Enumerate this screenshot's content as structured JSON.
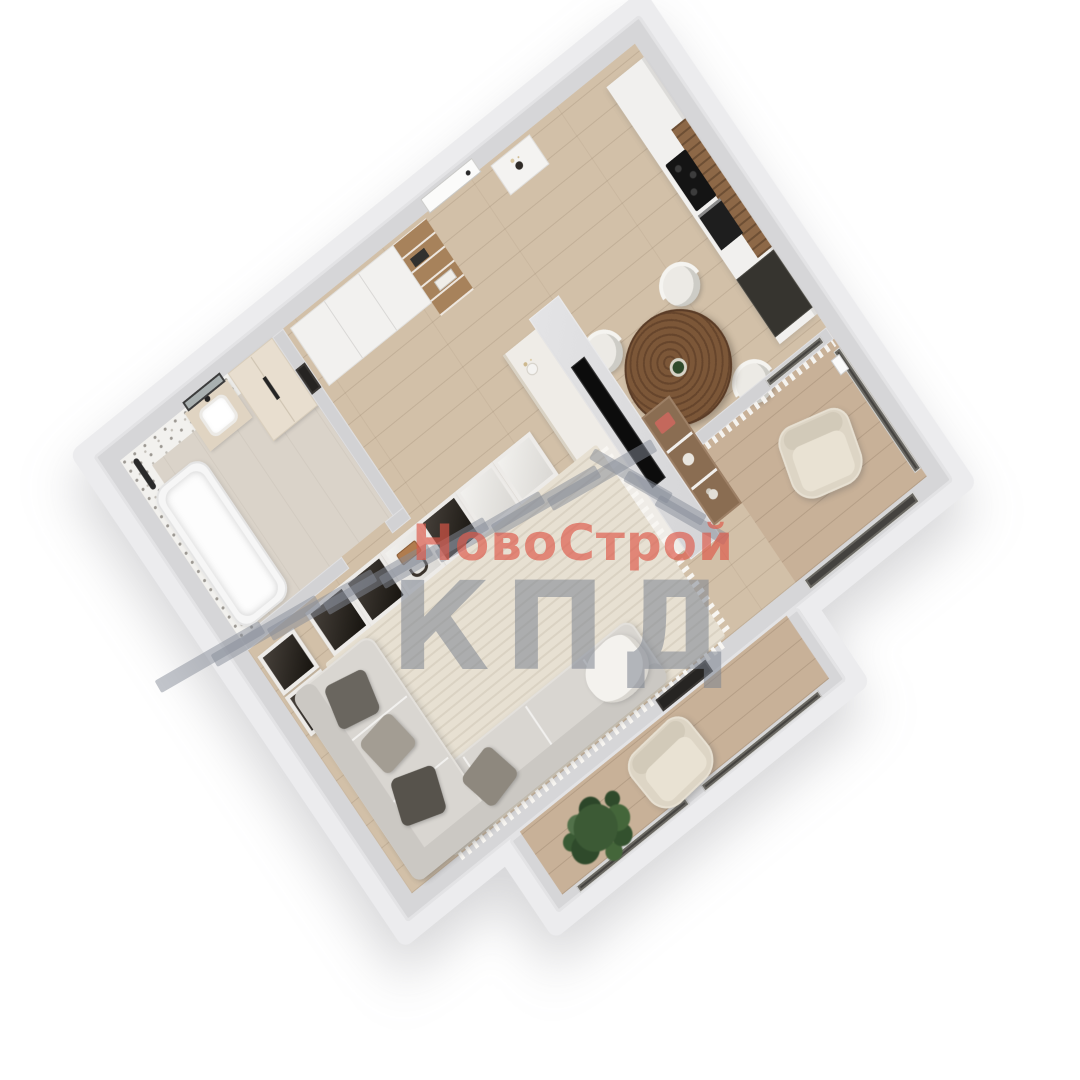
{
  "watermark": {
    "brand": "НовоСтрой",
    "abbr": "КПД",
    "brand_color": "#dd5648",
    "abbr_color": "#7c8490",
    "stripe_color": "#858c97"
  },
  "palette": {
    "background": "#ffffff",
    "wall_top": "#d6d6d8",
    "wall_inner": "#d2d2d4",
    "outer_skirt": "#ececee",
    "floor_wood": "#d2c0a8",
    "floor_balcony": "#c8b198",
    "floor_bathroom": "#dad3c9",
    "terrazzo": "#f2f1ee",
    "rug": "#e7e0d2",
    "sofa": "#d9d6d1",
    "pillow_dark": "#57534c",
    "pillow_mid": "#a39d93",
    "dining_table_wood": "#6f4e36",
    "chair": "#eceae5",
    "kitchen_cabinet": "#f1f0ee",
    "kitchen_wood": "#8d6847",
    "counter_dark": "#36342f",
    "cooktop": "#141414",
    "tv_black": "#0c0c0c",
    "glass_dark": "#44423f",
    "armchair": "#ddd5c5",
    "plant_green": "#3c5a35",
    "bookshelf_wood": "#a7825b"
  }
}
